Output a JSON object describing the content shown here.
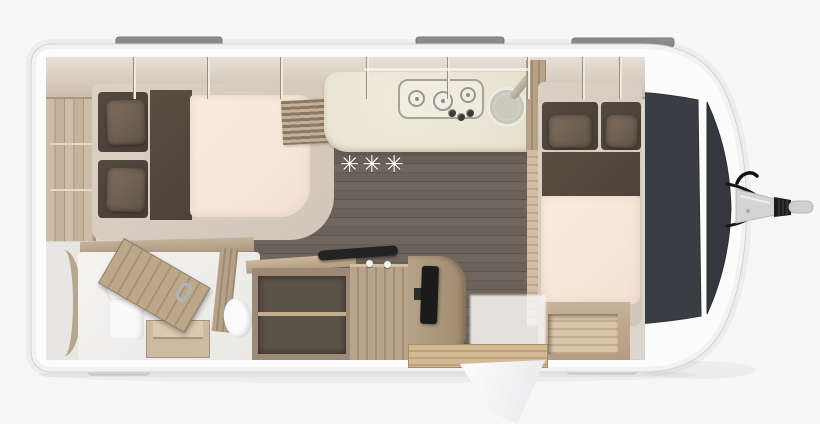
{
  "meta": {
    "title": "Caravan floor plan — top-view cutaway render",
    "canvas": {
      "width_px": 820,
      "height_px": 424
    }
  },
  "floor": {
    "marker": "✳✳✳"
  },
  "colors": {
    "background": "#f7f7f7",
    "body_shell": "#fcfcfd",
    "front_window": "#36393d",
    "wood_light": "#c8b7a2",
    "wood_mid": "#b3a18c",
    "floor_plank": "#6e635a",
    "mattress": "#f8e9dd",
    "bed_frame": "#d7ccc2",
    "cushion_dark": "#4e443c",
    "pillow_brown": "#6f6154",
    "worktop": "#e9e4d4",
    "tv_black": "#1b1b1b",
    "roof_rail_gray": "#8f8f92",
    "skid_gray": "#dadadc"
  },
  "exterior": {
    "roof_rails_count": 3,
    "front_window_panels": 2,
    "hitch": "A-frame drawbar with coupling head",
    "entrance_door_state": "open, swung outside at bottom wall"
  },
  "rooms": {
    "rear_bedroom": {
      "pillows": 2,
      "elements": [
        "overhead-lockers",
        "side-shelves",
        "backrest-cushions",
        "bed-runner",
        "mattress"
      ]
    },
    "kitchen": {
      "hob_burners": 3,
      "control_knobs": 3,
      "elements": [
        "worktop",
        "round-sink",
        "faucet",
        "louvered-vent",
        "tall-cabinet"
      ]
    },
    "living_area": {
      "elements": [
        "plank-floor",
        "floor-marker",
        "sideboard-open-shelves",
        "black-grab-handle",
        "tv-on-swivel-mount",
        "rounded-wardrobe"
      ]
    },
    "bathroom": {
      "elements": [
        "toilet",
        "washbasin",
        "curved-shower-wall",
        "wooden-door-open-with-chrome-handle",
        "step-stool"
      ]
    },
    "front_bedroom": {
      "pillows": 2,
      "elements": [
        "backrest-cushions",
        "bed-runner",
        "mattress",
        "under-bed-storage"
      ]
    }
  }
}
